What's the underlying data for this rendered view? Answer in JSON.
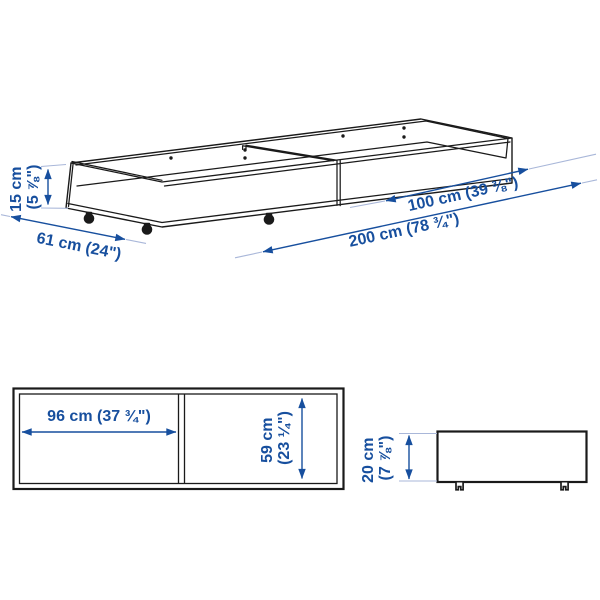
{
  "diagram": {
    "colors": {
      "dimension_text": "#174f9e",
      "dimension_line": "#174f9e",
      "extension_line": "#a9b7d9",
      "drawing_line": "#1a1a1a",
      "background": "#ffffff"
    },
    "perspective_view": {
      "dimensions": {
        "height": {
          "line1": "15 cm",
          "line2": "(5 ⅞\")"
        },
        "depth": {
          "text": "61 cm (24\")"
        },
        "half_length": {
          "text": "100 cm (39 ⅜\")"
        },
        "length": {
          "text": "200 cm (78 ¾\")"
        }
      }
    },
    "top_view": {
      "dimensions": {
        "inner_width": {
          "text": "96 cm (37 ¾\")"
        },
        "inner_depth": {
          "line1": "59 cm",
          "line2": "(23 ¼\")"
        }
      }
    },
    "side_view": {
      "dimensions": {
        "height": {
          "line1": "20 cm",
          "line2": "(7 ⅞\")"
        }
      }
    }
  }
}
